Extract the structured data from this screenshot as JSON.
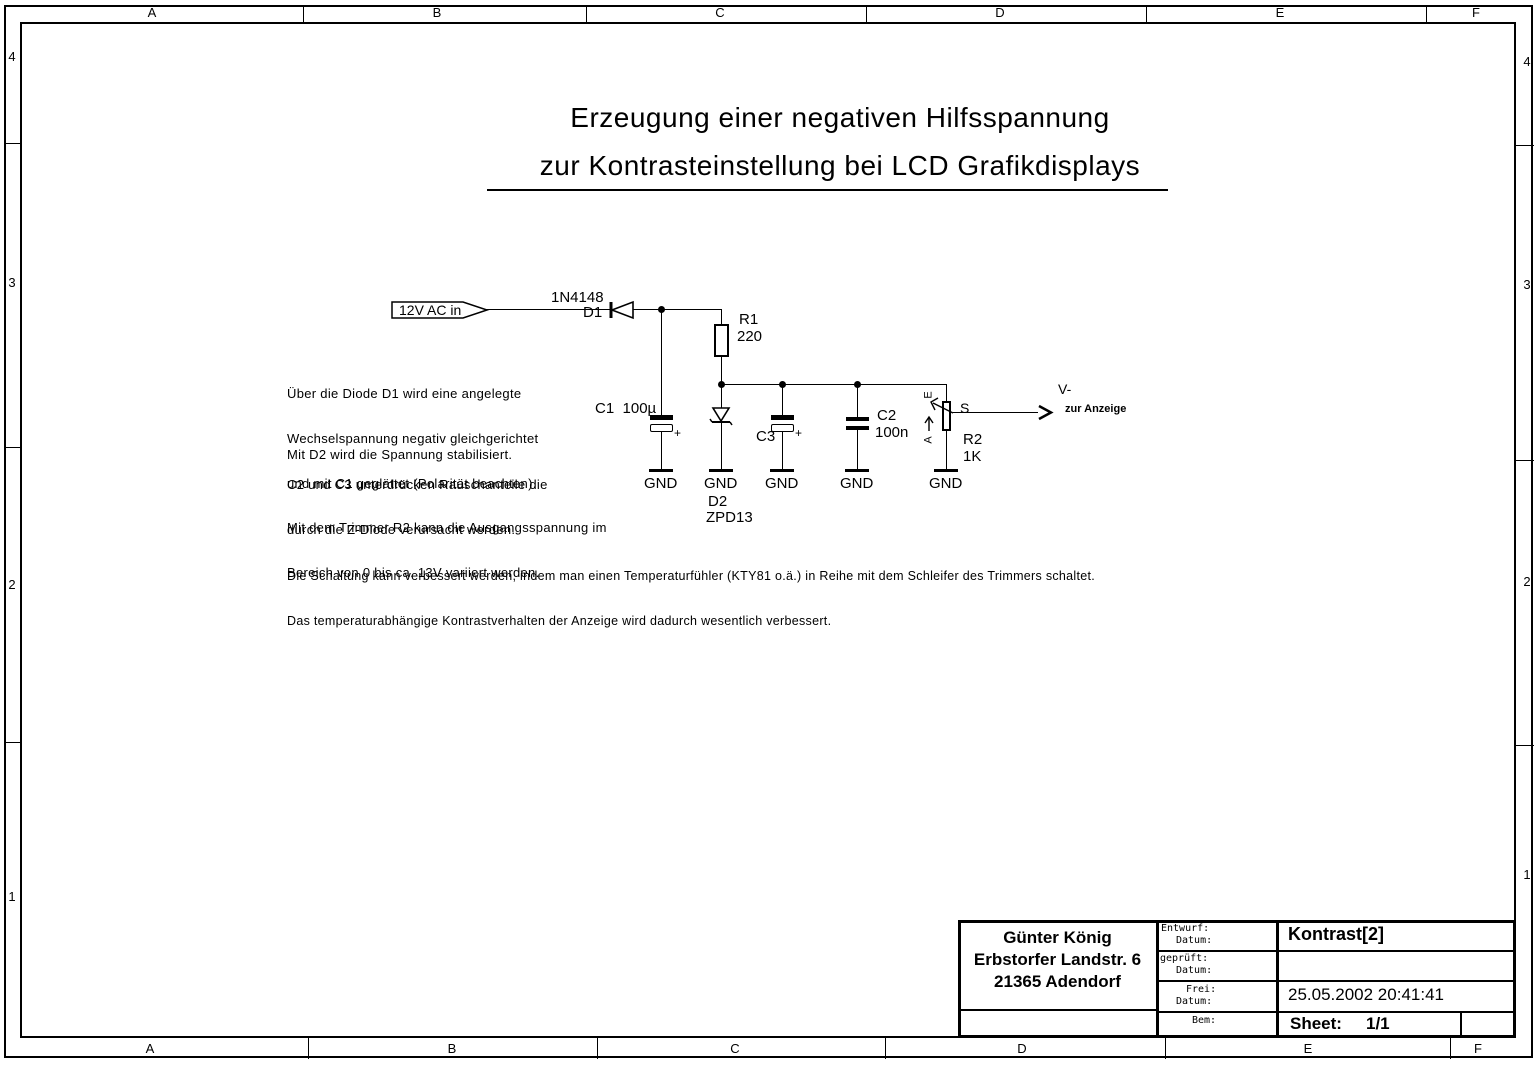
{
  "frame": {
    "top_labels": [
      "A",
      "B",
      "C",
      "D",
      "E",
      "F"
    ],
    "bottom_labels": [
      "A",
      "B",
      "C",
      "D",
      "E",
      "F"
    ],
    "left_labels": [
      "4",
      "3",
      "2",
      "1"
    ],
    "right_labels": [
      "4",
      "3",
      "2",
      "1"
    ]
  },
  "title": {
    "line1": "Erzeugung einer negativen Hilfsspannung",
    "line2": "zur Kontrasteinstellung bei LCD Grafikdisplays"
  },
  "notes": {
    "p1l1": "Über die Diode D1 wird eine angelegte",
    "p1l2": "Wechselspannung negativ gleichgerichtet",
    "p1l3": "und mit C1 geglättet (Polarität beachten).",
    "p2l1": "Mit D2 wird die Spannung stabilisiert.",
    "p3l1": "C2 und C3 unterdrücken Rauschanteile die",
    "p3l2": "durch die Z-Diode verursacht werden.",
    "p4l1": "Mit dem Trimmer R2 kann die Ausgangsspannung im",
    "p4l2": "Bereich von 0 bis ca. 13V variiert werden.",
    "p5l1": "Die Schaltung kann verbessert werden, indem man einen Temperaturfühler (KTY81 o.ä.) in Reihe mit dem Schleifer des Trimmers schaltet.",
    "p5l2": "Das temperaturabhängige Kontrastverhalten der Anzeige wird dadurch wesentlich verbessert."
  },
  "schematic": {
    "input_label": "12V AC in",
    "d1_part": "1N4148",
    "d1_ref": "D1",
    "r1_ref": "R1",
    "r1_value": "220",
    "c1_label": "C1  100µ",
    "c1_plus": "+",
    "c3_ref": "C3",
    "c3_plus": "+",
    "c2_ref": "C2",
    "c2_value": "100n",
    "d2_ref": "D2",
    "d2_part": "ZPD13",
    "r2_ref": "R2",
    "r2_value": "1K",
    "r2_pin_e": "E",
    "r2_pin_s": "S",
    "r2_pin_a": "A",
    "out_net": "V-",
    "out_sub": "zur Anzeige",
    "gnd": "GND"
  },
  "titleblock": {
    "author_name": "Günter König",
    "author_street": "Erbstorfer Landstr. 6",
    "author_city": "21365 Adendorf",
    "f_entwurf": "Entwurf:",
    "f_datum": "Datum:",
    "f_geprueft": "geprüft:",
    "f_frei": "Frei:",
    "f_bem": "Bem:",
    "doc_title": "Kontrast[2]",
    "doc_datetime": "25.05.2002 20:41:41",
    "sheet_label": "Sheet:",
    "sheet_value": "1/1"
  },
  "colors": {
    "ink": "#000000",
    "paper": "#ffffff"
  }
}
